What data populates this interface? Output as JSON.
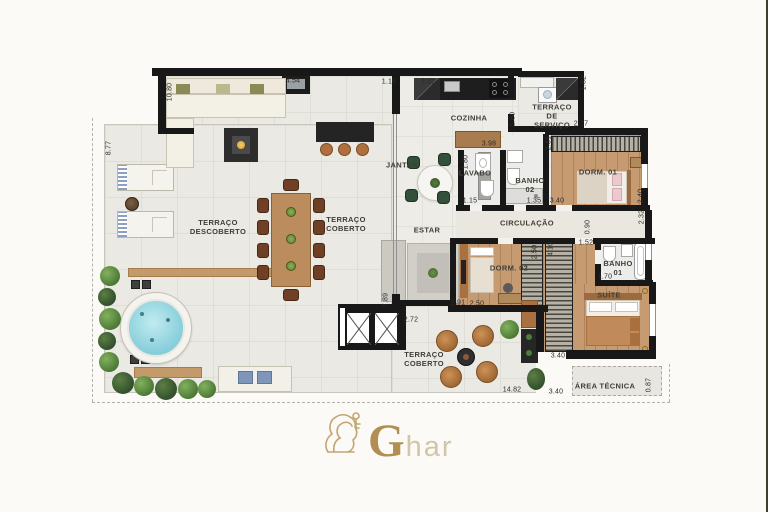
{
  "page": {
    "background": "#fbfaf6",
    "right_edge_strip": "#3d3f2f"
  },
  "logo": {
    "g": "G",
    "rest": "har",
    "icon": "lion-and-key",
    "gold": "#b28e52",
    "gold_light": "#d3c5a8"
  },
  "palette": {
    "wall": "#181818",
    "tile_floor": "#eae9e4",
    "wood_floor": "#c79b72",
    "water": "#8ed2dd",
    "greenery": "#5d8a43",
    "counter_dark": "#1e1e1e",
    "counter_wood": "#a97c4f",
    "dashed_line": "#b5b2a8"
  },
  "room_labels": [
    {
      "text": "TERRAÇO\nDESCOBERTO",
      "x": 218,
      "y": 227
    },
    {
      "text": "TERRAÇO\nCOBERTO",
      "x": 346,
      "y": 224
    },
    {
      "text": "JANTAR",
      "x": 402,
      "y": 165
    },
    {
      "text": "ESTAR",
      "x": 427,
      "y": 230
    },
    {
      "text": "COZINHA",
      "x": 469,
      "y": 118
    },
    {
      "text": "LAVABO",
      "x": 475,
      "y": 173
    },
    {
      "text": "BANHO\n02",
      "x": 530,
      "y": 185
    },
    {
      "text": "TERRAÇO\nDE\nSERVIÇO",
      "x": 552,
      "y": 116
    },
    {
      "text": "DORM. 01",
      "x": 598,
      "y": 172
    },
    {
      "text": "CIRCULAÇÃO",
      "x": 527,
      "y": 223
    },
    {
      "text": "DORM. 02",
      "x": 509,
      "y": 268
    },
    {
      "text": "BANHO\n01",
      "x": 618,
      "y": 268
    },
    {
      "text": "SUÍTE",
      "x": 609,
      "y": 295
    },
    {
      "text": "TERRAÇO\nCOBERTO",
      "x": 424,
      "y": 359
    },
    {
      "text": "ÁREA TÉCNICA",
      "x": 605,
      "y": 386
    }
  ],
  "dimensions": [
    {
      "text": "10.80",
      "x": 170,
      "y": 92,
      "v": true
    },
    {
      "text": "8.77",
      "x": 109,
      "y": 148,
      "v": true
    },
    {
      "text": "4.54",
      "x": 293,
      "y": 81
    },
    {
      "text": "1.16",
      "x": 389,
      "y": 82
    },
    {
      "text": "3.32",
      "x": 428,
      "y": 82
    },
    {
      "text": "1.82",
      "x": 584,
      "y": 83,
      "v": true
    },
    {
      "text": "2.27",
      "x": 581,
      "y": 124
    },
    {
      "text": "1.80",
      "x": 513,
      "y": 119,
      "v": true
    },
    {
      "text": "3.98",
      "x": 489,
      "y": 144
    },
    {
      "text": "2.31",
      "x": 549,
      "y": 143,
      "v": true
    },
    {
      "text": "1.80",
      "x": 466,
      "y": 162,
      "v": true
    },
    {
      "text": "1.15",
      "x": 470,
      "y": 201
    },
    {
      "text": "1.35",
      "x": 534,
      "y": 201
    },
    {
      "text": "3.40",
      "x": 557,
      "y": 201
    },
    {
      "text": "2.40",
      "x": 641,
      "y": 196,
      "v": true
    },
    {
      "text": "2.32",
      "x": 642,
      "y": 217,
      "v": true
    },
    {
      "text": "0.90",
      "x": 588,
      "y": 227,
      "v": true
    },
    {
      "text": "1.52",
      "x": 586,
      "y": 243
    },
    {
      "text": "2.50",
      "x": 535,
      "y": 252,
      "v": true
    },
    {
      "text": "4.10",
      "x": 551,
      "y": 249,
      "v": true
    },
    {
      "text": "1.70",
      "x": 605,
      "y": 277
    },
    {
      "text": "2.91",
      "x": 458,
      "y": 303
    },
    {
      "text": "2.50",
      "x": 477,
      "y": 304
    },
    {
      "text": "7.89",
      "x": 386,
      "y": 300,
      "v": true
    },
    {
      "text": "2.72",
      "x": 411,
      "y": 320
    },
    {
      "text": "14.82",
      "x": 512,
      "y": 390
    },
    {
      "text": "3.40",
      "x": 558,
      "y": 356
    },
    {
      "text": "3.40",
      "x": 556,
      "y": 392
    },
    {
      "text": "0.87",
      "x": 649,
      "y": 385,
      "v": true
    }
  ]
}
